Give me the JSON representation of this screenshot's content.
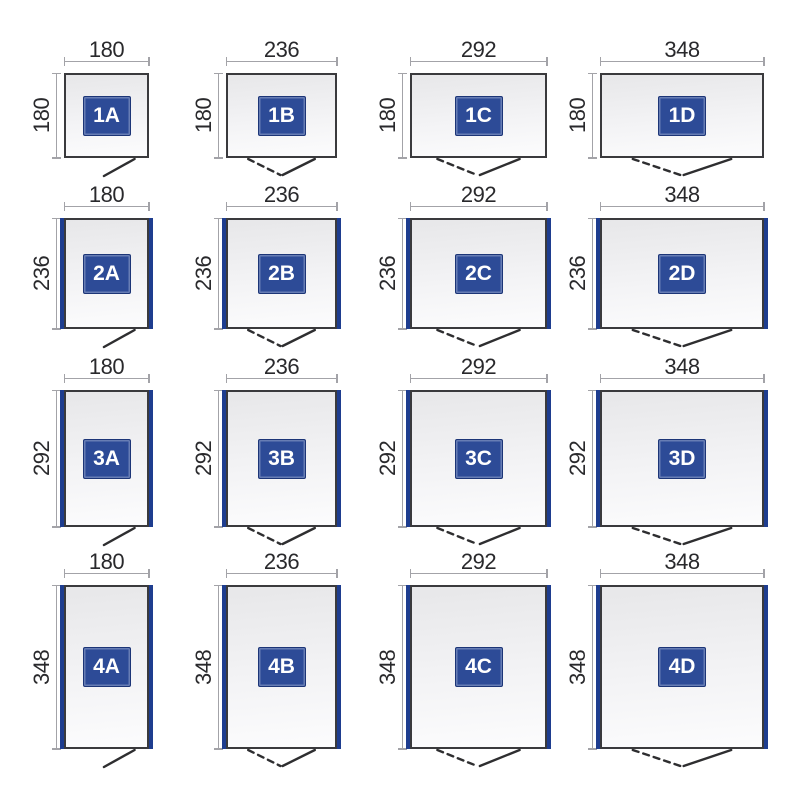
{
  "diagram": {
    "column_width_labels": [
      "180",
      "236",
      "292",
      "348"
    ],
    "row_depth_labels": [
      "180",
      "236",
      "292",
      "348"
    ],
    "cells": [
      {
        "label": "1A",
        "width": 180,
        "depth": 180,
        "door": "single",
        "side_panels": false
      },
      {
        "label": "1B",
        "width": 236,
        "depth": 180,
        "door": "double",
        "side_panels": false
      },
      {
        "label": "1C",
        "width": 292,
        "depth": 180,
        "door": "double",
        "side_panels": false
      },
      {
        "label": "1D",
        "width": 348,
        "depth": 180,
        "door": "double",
        "side_panels": false
      },
      {
        "label": "2A",
        "width": 180,
        "depth": 236,
        "door": "single",
        "side_panels": true
      },
      {
        "label": "2B",
        "width": 236,
        "depth": 236,
        "door": "double",
        "side_panels": true
      },
      {
        "label": "2C",
        "width": 292,
        "depth": 236,
        "door": "double",
        "side_panels": true
      },
      {
        "label": "2D",
        "width": 348,
        "depth": 236,
        "door": "double",
        "side_panels": true
      },
      {
        "label": "3A",
        "width": 180,
        "depth": 292,
        "door": "single",
        "side_panels": true
      },
      {
        "label": "3B",
        "width": 236,
        "depth": 292,
        "door": "double",
        "side_panels": true
      },
      {
        "label": "3C",
        "width": 292,
        "depth": 292,
        "door": "double",
        "side_panels": true
      },
      {
        "label": "3D",
        "width": 348,
        "depth": 292,
        "door": "double",
        "side_panels": true
      },
      {
        "label": "4A",
        "width": 180,
        "depth": 348,
        "door": "single",
        "side_panels": true
      },
      {
        "label": "4B",
        "width": 236,
        "depth": 348,
        "door": "double",
        "side_panels": true
      },
      {
        "label": "4C",
        "width": 292,
        "depth": 348,
        "door": "double",
        "side_panels": true
      },
      {
        "label": "4D",
        "width": 348,
        "depth": 348,
        "door": "double",
        "side_panels": true
      }
    ],
    "colors": {
      "background": "#ffffff",
      "outline": "#3a3a3d",
      "dimension_line": "#a3a3a8",
      "dimension_text": "#29292c",
      "panel_blue": "#1e3d8f",
      "badge_blue": "#2d4b97",
      "badge_border": "#1c3577",
      "badge_text": "#ffffff",
      "fill_top": "#e7e7e9",
      "fill_bottom": "#fcfcfd",
      "door_line": "#2e2e30"
    }
  }
}
